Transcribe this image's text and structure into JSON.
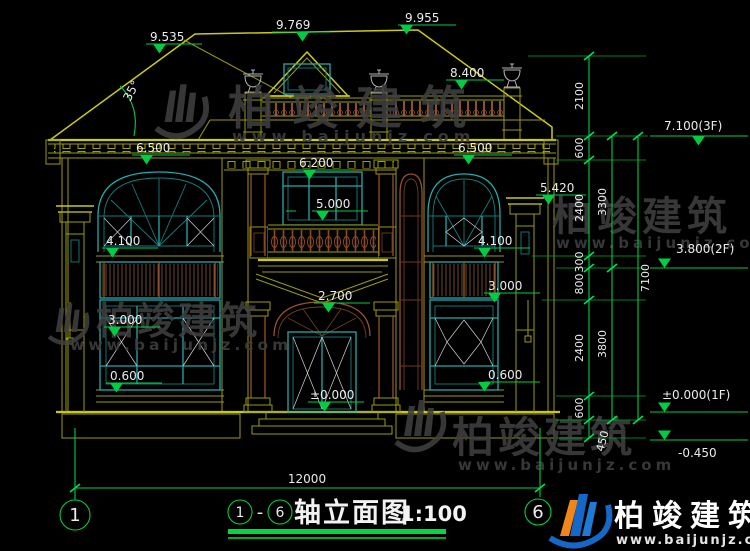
{
  "title_block": {
    "axis_start": "1",
    "axis_end": "6",
    "separator": "-",
    "name": "轴立面图",
    "scale": "1:100"
  },
  "axis_bubbles": {
    "left": "1",
    "right": "6"
  },
  "elevations": {
    "roof_left": "9.535",
    "ridge": "9.769",
    "roof_right": "9.955",
    "roof_deck": "8.400",
    "roof_angle": "35°",
    "eave_left": "6.500",
    "eave_right": "6.500",
    "window_2f_top": "6.200",
    "balcony_window": "5.000",
    "pillar_right_top": "5.420",
    "arch_top": "2.700",
    "door_base": "±0.000",
    "left_wing": {
      "upper_sill": "4.100",
      "louver_base": "3.000",
      "lower_sill": "0.600"
    },
    "right_wing": {
      "upper_sill": "4.100",
      "louver_base": "3.000",
      "lower_sill": "0.600"
    },
    "levels": {
      "floor3": "7.100(3F)",
      "floor2": "3.800(2F)",
      "floor1": "±0.000(1F)",
      "ground_offset": "-0.450"
    }
  },
  "dimensions": {
    "chain_inner": [
      "2100",
      "600",
      "2400",
      "300",
      "800",
      "2400",
      "600",
      "450"
    ],
    "chain_floor": [
      "3300",
      "3800"
    ],
    "chain_total": "7100",
    "width_total": "12000"
  },
  "watermark": {
    "brand": "柏竣建筑",
    "url": "www.baijunjz.com"
  },
  "logo": {
    "brand": "柏竣建筑",
    "url": "www.baijunjz.com"
  },
  "colors": {
    "line_yellow": "#caca16",
    "dim_green": "#00cd42",
    "window_teal": "#25aaaa",
    "wood_brown": "#96522a",
    "text_white": "#ebebeb",
    "logo_blue": "#1668c8",
    "logo_orange": "#f08519"
  }
}
